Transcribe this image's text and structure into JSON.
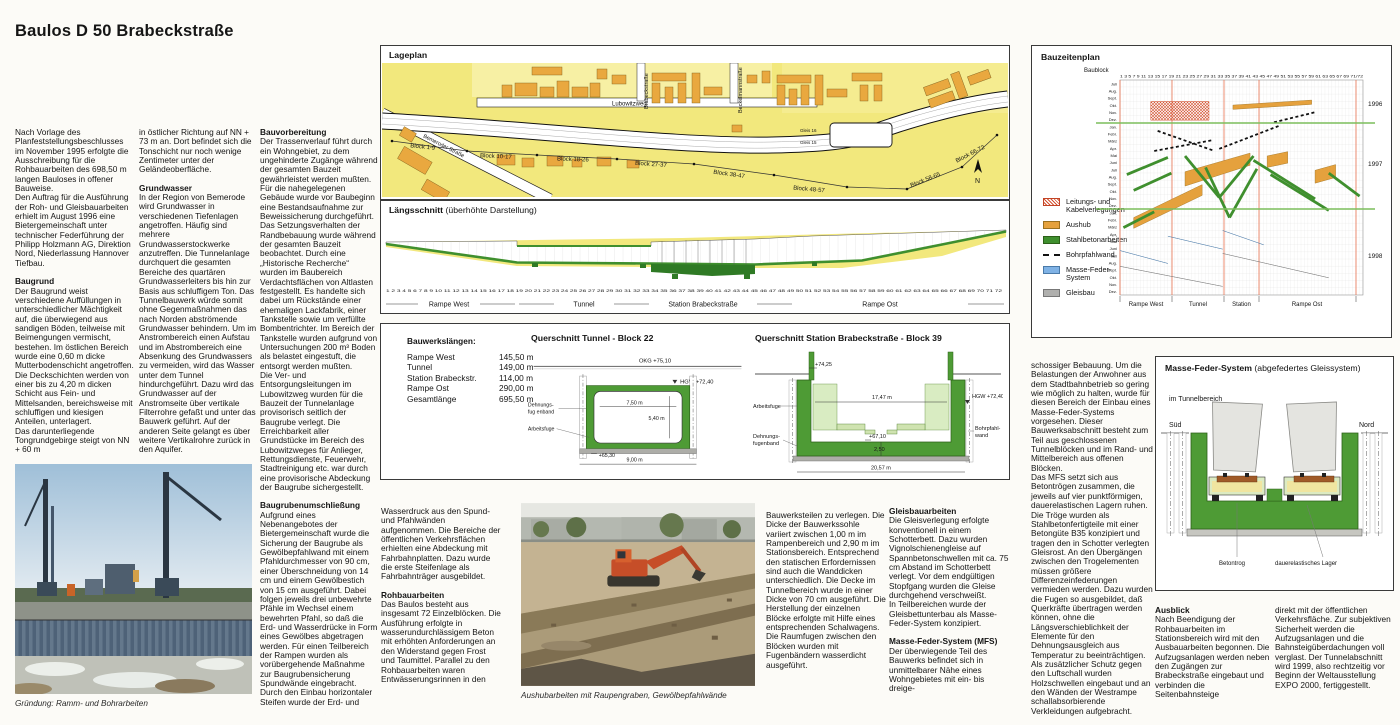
{
  "title": "Baulos D 50 Brabeckstraße",
  "col1": {
    "p1": "Nach Vorlage des Planfeststellungsbeschlusses im November 1995 erfolgte die Ausschreibung für die Rohbauarbeiten des 698,50 m langen Bauloses in offener Bauweise.\nDen Auftrag für die Ausführung der Roh- und Gleisbauarbeiten erhielt im August 1996 eine Bietergemeinschaft unter technischer Federführung der Philipp Holzmann AG, Direktion Nord, Niederlassung Hannover Tiefbau.",
    "h1": "Baugrund",
    "p2": "Der Baugrund weist verschiedene Auffüllungen in unterschiedlicher Mächtigkeit auf, die überwiegend aus sandigen Böden, teilweise mit Beimengungen vermischt, bestehen. Im östlichen Bereich wurde eine 0,60 m dicke Mutterbodenschicht angetroffen.\nDie Deckschichten werden von einer bis zu 4,20 m dicken Schicht aus Fein- und Mittelsanden, bereichsweise mit schluffigen und kiesigen Anteilen, unterlagert.\nDas darunterliegende Tongrundgebirge steigt von NN + 60 m"
  },
  "col2": {
    "p1": "in östlicher Richtung auf NN + 73 m an. Dort befindet sich die Tonschicht nur noch wenige Zentimeter unter der Geländeoberfläche.",
    "h1": "Grundwasser",
    "p2": "In der Region von Bemerode wird Grundwasser in verschiedenen Tiefenlagen angetroffen. Häufig sind mehrere Grundwasserstockwerke anzutreffen. Die Tunnelanlage durchquert die gesamten Bereiche des quartären Grundwasserleiters bis hin zur Basis aus schluffigem Ton. Das Tunnelbauwerk würde somit ohne Gegenmaßnahmen das nach Norden abströmende Grundwasser behindern. Um im Anstrombereich einen Aufstau und im Abstrombereich eine Absenkung des Grundwassers zu vermeiden, wird das Wasser unter dem Tunnel hindurchgeführt. Dazu wird das Grundwasser auf der Anstromseite über vertikale Filterrohre gefaßt und unter das Bauwerk geführt. Auf der anderen Seite gelangt es über weitere Vertikalrohre zurück in den Aquifer."
  },
  "col3": {
    "h1": "Bauvorbereitung",
    "p1": "Der Trassenverlauf führt durch ein Wohngebiet, zu dem ungehinderte Zugänge während der gesamten Bauzeit gewährleistet werden mußten.\nFür die nahegelegenen Gebäude wurde vor Baubeginn eine Bestandsaufnahme zur Beweissicherung durchgeführt. Das Setzungsverhalten der Randbebauung wurde während der gesamten Bauzeit beobachtet. Durch eine „Historische Recherche“ wurden im Baubereich Verdachtsflächen von Altlasten festgestellt. Es handelte sich dabei um Rückstände einer ehemaligen Lackfabrik, einer Tankstelle sowie um verfüllte Bombentrichter. Im Bereich der Tankstelle wurden aufgrund von Untersuchungen 200 m³ Boden als belastet eingestuft, die entsorgt werden mußten.\nDie Ver- und Entsorgungsleitungen im Lubowitzweg wurden für die Bauzeit der Tunnelanlage provisorisch seitlich der Baugrube verlegt. Die Erreichbarkeit aller Grundstücke im Bereich des Lubowitzweges für Anlieger, Rettungsdienste, Feuerwehr, Stadtreinigung etc. war durch eine provisorische Abdeckung der Baugrube sichergestellt.",
    "h2": "Baugrubenumschließung",
    "p2": "Aufgrund eines Nebenangebotes der Bietergemeinschaft wurde die Sicherung der Baugrube als Gewölbepfahlwand mit einem Pfahldurchmesser von 90 cm, einer Überschneidung von 14 cm und einem Gewölbestich von 15 cm ausgeführt. Dabei folgen jeweils drei unbewehrte Pfähle im Wechsel einem bewehrten Pfahl, so daß die Erd- und Wasserdrücke in Form eines Gewölbes abgetragen werden. Für einen Teilbereich der Rampen wurden als vorübergehende Maßnahme zur Baugrubensicherung Spundwände eingebracht.\nDurch den Einbau horizontaler Steifen wurde der Erd- und"
  },
  "col4": {
    "p1": "Wasserdruck aus den Spund- und Pfahlwänden aufgenommen. Die Bereiche der öffentlichen Verkehrsflächen erhielten eine Abdeckung mit Fahrbahnplatten. Dazu wurde die erste Steifenlage als Fahrbahnträger ausgebildet.",
    "h1": "Rohbauarbeiten",
    "p2": "Das Baulos besteht aus insgesamt 72 Einzelblöcken. Die Ausführung erfolgte in wasserundurchlässigem Beton mit erhöhten Anforderungen an den Widerstand gegen Frost und Taumittel. Parallel zu den Rohbauarbeiten waren Entwässerungsrinnen in den"
  },
  "col5": {
    "p1": "Bauwerksteilen zu verlegen. Die Dicke der Bauwerkssohle variiert zwischen 1,00 m im Rampenbereich und 2,90 m im Stationsbereich. Entsprechend den statischen Erfordernissen sind auch die Wanddicken unterschiedlich. Die Decke im Tunnelbereich wurde in einer Dicke von 70 cm ausgeführt. Die Herstellung der einzelnen Blöcke erfolgte mit Hilfe eines entsprechenden Schalwagens. Die Raumfugen zwischen den Blöcken wurden mit Fugenbändern wasserdicht ausgeführt."
  },
  "col6": {
    "h1": "Gleisbauarbeiten",
    "p1": "Die Gleisverlegung erfolgte konventionell in einem Schotterbett. Dazu wurden Vignolschienengleise auf Spannbetonschwellen mit ca. 75 cm Abstand im Schotterbett verlegt. Vor dem endgültigen Stopfgang wurden die Gleise durchgehend verschweißt.\nIn Teilbereichen wurde der Gleisbettunterbau als Masse-Feder-System konzipiert.",
    "h2": "Masse-Feder-System (MFS)",
    "p2": "Der überwiegende Teil des Bauwerks befindet sich in unmittelbarer Nähe eines Wohngebietes mit ein- bis dreige-"
  },
  "col7": {
    "p1": "schossiger Bebauung. Um die Belastungen der Anwohner aus dem Stadtbahnbetrieb so gering wie möglich zu halten, wurde für diesen Bereich der Einbau eines Masse-Feder-Systems vorgesehen. Dieser Bauwerksabschnitt besteht zum Teil aus geschlossenen Tunnelblöcken und im Rand- und Mittelbereich aus offenen Blöcken.\nDas MFS setzt sich aus Betontrögen zusammen, die jeweils auf vier punktförmigen, dauerelastischen Lagern ruhen. Die Tröge wurden als Stahlbetonfertigteile mit einer Betongüte B35 konzipiert und tragen den in Schotter verlegten Gleisrost. An den Übergängen zwischen den Trogelementen müssen größere Differenzeinfederungen vermieden werden. Dazu wurden die Fugen so ausgebildet, daß Querkräfte übertragen werden können, ohne die Längsverschieblichkeit der Elemente für den Dehnungsausgleich aus Temperatur zu beeinträchtigen.\nAls zusätzlicher Schutz gegen den Luftschall wurden Holzschwellen eingebaut und an den Wänden der Westrampe schallabsorbierende Verkleidungen aufgebracht."
  },
  "col8": {
    "h1": "Ausblick",
    "p1": "Nach Beendigung der Rohbauarbeiten im Stationsbereich wird mit den Ausbauarbeiten begonnen. Die Aufzugsanlagen werden neben den Zugängen zur Brabeckstraße eingebaut und verbinden die Seitenbahnsteige"
  },
  "col9": {
    "p1": "direkt mit der öffentlichen Verkehrsfläche. Zur subjektiven Sicherheit werden die Aufzugsanlagen und die Bahnsteigüberdachungen voll verglast. Der Tunnelabschnitt wird 1999, also rechtzeitig vor Beginn der Weltausstellung EXPO 2000, fertiggestellt."
  },
  "photos": {
    "caption1": "Gründung: Ramm- und Bohrarbeiten",
    "caption2": "Aushubarbeiten mit Raupengraben, Gewölbepfahlwände"
  },
  "lageplan": {
    "title": "Lageplan",
    "street_lubowitzweg": "Lubowitzweg",
    "street_bemeroder": "Bemeroder Straße",
    "street_brabeck": "Brabeckstraße",
    "street_beckelmann": "Beckelmannstraße",
    "gleis16": "Gleis 16",
    "gleis15": "Gleis 15",
    "north": "N",
    "blocks": [
      "Block 1-9",
      "Block 10-17",
      "Block 18-26",
      "Block 27-37",
      "Block 38-47",
      "Block 48-57",
      "Block 58-65",
      "Block 66-72"
    ]
  },
  "laengsschnitt": {
    "title": "Längsschnitt",
    "subtitle": "(überhöhte Darstellung)",
    "sections": [
      "Rampe West",
      "Tunnel",
      "Station Brabeckstraße",
      "Rampe Ost"
    ],
    "ticks": "1 2 3 4 5 6 7 8 9 10 11 12 13 14 15 16 17 18 19 20 21 22 23 24 25 26 27 28 29 30 31 32 33 34 35 36 37 38 39 40 41 42 43 44 45 46 47 48 49 50 51 52 53 54 55 56 57 58 59 60 61 62 63 64 65 66 67 68 69 70 71 72"
  },
  "bauwerkslaengen": {
    "title": "Bauwerkslängen:",
    "rows": [
      {
        "label": "Rampe West",
        "value": "145,50 m"
      },
      {
        "label": "Tunnel",
        "value": "149,00 m"
      },
      {
        "label": "Station Brabeckstr.",
        "value": "114,00 m"
      },
      {
        "label": "Rampe Ost",
        "value": "290,00 m"
      },
      {
        "label": "Gesamtlänge",
        "value": "695,50 m"
      }
    ]
  },
  "qs_tunnel": {
    "title": "Querschnitt Tunnel - Block 22",
    "okg": "OKG +75,10",
    "hgw": "HGW +72,40",
    "w_in": "7,50 m",
    "h_in": "5,40 m",
    "lvl": "+65,30",
    "w_out": "9,00 m",
    "lbl_df1": "Dehnungs-",
    "lbl_df2": "fug enband",
    "lbl_af": "Arbeitsfuge"
  },
  "qs_station": {
    "title": "Querschnitt Station Brabeckstraße - Block 39",
    "top": "+74,25",
    "w_in": "17,47 m",
    "hgw": "HGW +72,40",
    "lvl": "+67,10",
    "slab": "2,50",
    "w_out": "20,57 m",
    "lbl_af": "Arbeitsfuge",
    "lbl_df1": "Dehnungs-",
    "lbl_df2": "fugenband",
    "lbl_bp1": "Bohrpfahl-",
    "lbl_bp2": "wand"
  },
  "bauzeitenplan": {
    "title": "Bauzeitenplan",
    "axis": "Baublock",
    "blocknums": "1 3 5 7 9 11 13 15 17 19 21 23 25 27 29 31 33 35 37 39 41 43 45 47 49 51 53 55 57 59 61 63 65 67 69 71/72",
    "months": [
      "Juli",
      "Aug.",
      "Sept.",
      "Okt.",
      "Nov.",
      "Dez.",
      "Jan.",
      "Febr.",
      "März",
      "Apr.",
      "Mai",
      "Juni",
      "Juli",
      "Aug.",
      "Sept.",
      "Okt.",
      "Nov.",
      "Dez.",
      "Jan.",
      "Febr.",
      "März",
      "Apr.",
      "Mai",
      "Juni",
      "Juli",
      "Aug.",
      "Sept.",
      "Okt.",
      "Nov.",
      "Dez."
    ],
    "years": [
      "1996",
      "1997",
      "1998"
    ],
    "sections": [
      "Rampe West",
      "Tunnel",
      "Station",
      "Rampe Ost"
    ],
    "legend": [
      {
        "label": "Leitungs- und Kabelverlegungen",
        "type": "hatch"
      },
      {
        "label": "Aushub",
        "type": "aushub"
      },
      {
        "label": "Stahlbetonarbeiten",
        "type": "beton"
      },
      {
        "label": "Bohrpfahlwand",
        "type": "bohr"
      },
      {
        "label": "Masse-Feder-System",
        "type": "mfs"
      },
      {
        "label": "Gleisbau",
        "type": "gleis"
      }
    ],
    "colors": {
      "hatch": "#D4502E",
      "aushub": "#E5A13D",
      "beton": "#3F8F2E",
      "bohr": "#111111",
      "mfs": "#7FB2E5",
      "gleis": "#B0B0AE"
    },
    "bars": [
      {
        "t": "hatch",
        "p": [
          [
            10,
            3.0
          ],
          [
            27,
            3.0
          ],
          [
            27,
            5.6
          ],
          [
            10,
            5.6
          ]
        ]
      },
      {
        "t": "aushub",
        "p": [
          [
            34,
            3.5
          ],
          [
            57,
            2.8
          ],
          [
            57,
            3.4
          ],
          [
            34,
            4.1
          ]
        ]
      },
      {
        "t": "aushub",
        "p": [
          [
            20,
            12.8
          ],
          [
            39,
            10.2
          ],
          [
            39,
            11.9
          ],
          [
            20,
            14.8
          ]
        ]
      },
      {
        "t": "aushub",
        "p": [
          [
            5,
            19.2
          ],
          [
            25,
            14.6
          ],
          [
            25,
            16.1
          ],
          [
            5,
            20.7
          ]
        ]
      },
      {
        "t": "aushub",
        "p": [
          [
            58,
            12.6
          ],
          [
            64,
            11.8
          ],
          [
            64,
            13.6
          ],
          [
            58,
            14.4
          ]
        ]
      },
      {
        "t": "aushub",
        "p": [
          [
            44,
            10.6
          ],
          [
            50,
            10.0
          ],
          [
            50,
            11.6
          ],
          [
            44,
            12.2
          ]
        ]
      },
      {
        "t": "bohr",
        "p": [
          [
            12,
            7.1
          ],
          [
            28,
            9.8
          ]
        ]
      },
      {
        "t": "bohr",
        "p": [
          [
            11,
            9.9
          ],
          [
            28,
            8.4
          ]
        ]
      },
      {
        "t": "bohr",
        "p": [
          [
            30,
            9.6
          ],
          [
            48,
            6.3
          ]
        ]
      },
      {
        "t": "bohr",
        "p": [
          [
            46,
            5.9
          ],
          [
            58,
            4.5
          ]
        ]
      },
      {
        "t": "beton",
        "p": [
          [
            3,
            13.2
          ],
          [
            15,
            10.8
          ]
        ]
      },
      {
        "t": "beton",
        "p": [
          [
            5,
            15.4
          ],
          [
            16,
            13.0
          ]
        ]
      },
      {
        "t": "beton",
        "p": [
          [
            2,
            20.6
          ],
          [
            11,
            18.4
          ]
        ]
      },
      {
        "t": "beton",
        "p": [
          [
            20,
            10.6
          ],
          [
            30,
            16.4
          ]
        ]
      },
      {
        "t": "beton",
        "p": [
          [
            30,
            16.4
          ],
          [
            40,
            10.6
          ]
        ]
      },
      {
        "t": "beton",
        "p": [
          [
            26,
            12.2
          ],
          [
            33,
            19.2
          ]
        ]
      },
      {
        "t": "beton",
        "p": [
          [
            33,
            19.2
          ],
          [
            41,
            12.4
          ]
        ]
      },
      {
        "t": "beton",
        "p": [
          [
            40,
            11.2
          ],
          [
            58,
            16.6
          ]
        ]
      },
      {
        "t": "beton",
        "p": [
          [
            45,
            13.2
          ],
          [
            62,
            18.2
          ]
        ]
      },
      {
        "t": "beton",
        "p": [
          [
            62,
            13.0
          ],
          [
            71,
            16.2
          ]
        ]
      },
      {
        "t": "mfs",
        "p": [
          [
            15,
            21.8
          ],
          [
            31,
            23.6
          ]
        ]
      },
      {
        "t": "mfs",
        "p": [
          [
            31,
            21.0
          ],
          [
            43,
            23.0
          ]
        ]
      },
      {
        "t": "mfs",
        "p": [
          [
            1,
            23.8
          ],
          [
            15,
            25.6
          ]
        ]
      },
      {
        "t": "gleis",
        "p": [
          [
            1,
            26.0
          ],
          [
            31,
            28.8
          ]
        ]
      },
      {
        "t": "gleis",
        "p": [
          [
            31,
            24.2
          ],
          [
            62,
            27.6
          ]
        ]
      }
    ]
  },
  "mfs": {
    "title": "Masse-Feder-System",
    "subtitle": "(abgefedertes Gleissystem)",
    "area": "im Tunnelbereich",
    "left": "Süd",
    "right": "Nord",
    "lbl1": "Betontrog",
    "lbl2": "dauerelastisches Lager"
  }
}
